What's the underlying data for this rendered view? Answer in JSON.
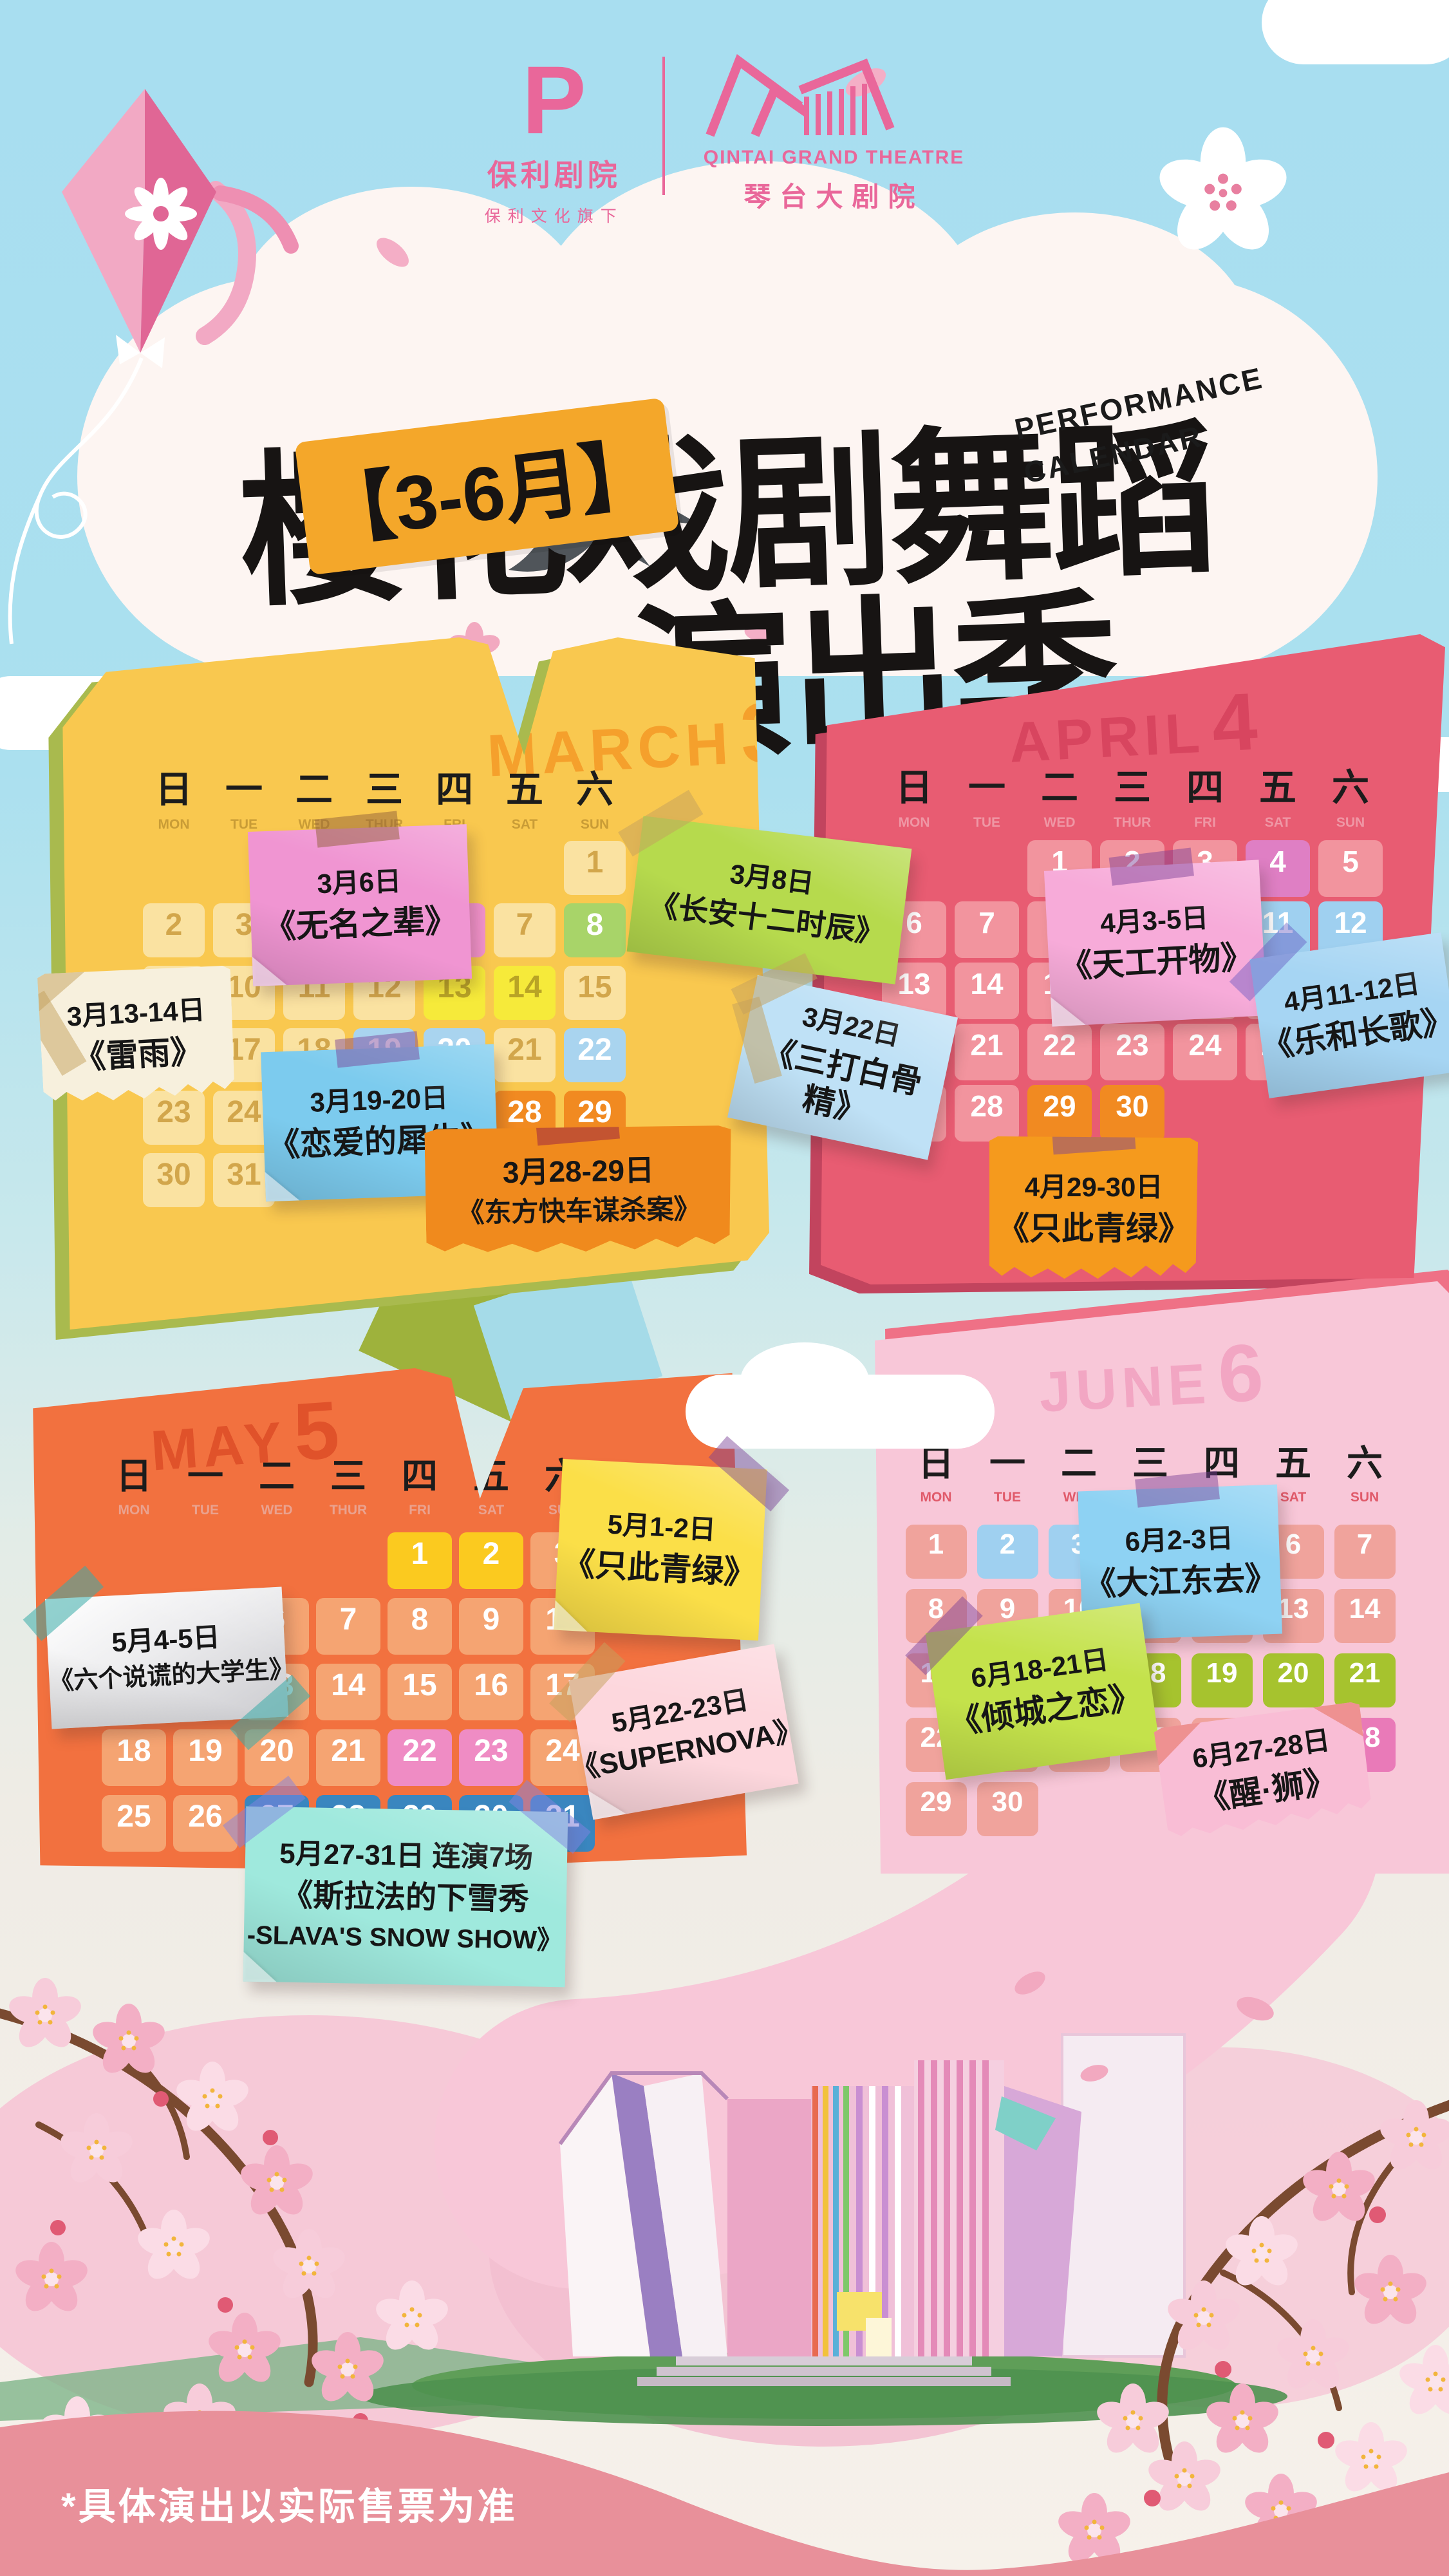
{
  "header": {
    "poly_logo": {
      "glyph": "P",
      "name_cn": "保利剧院",
      "sub_cn": "保利文化旗下"
    },
    "qintai_logo": {
      "name_en": "QINTAI GRAND THEATRE",
      "name_cn": "琴台大剧院"
    }
  },
  "title": {
    "line1": "樱花戏剧舞蹈",
    "line2": "演出季",
    "badge": "【3-6月】",
    "subtitle_en_line1": "PERFORMANCE",
    "subtitle_en_line2": "CALENDAR"
  },
  "months": [
    {
      "id": "march",
      "name_en": "MARCH",
      "num": "3",
      "weekdays_cn": [
        "日",
        "一",
        "二",
        "三",
        "四",
        "五",
        "六"
      ],
      "weekdays_en": [
        "MON",
        "TUE",
        "WED",
        "THUR",
        "FRI",
        "SAT",
        "SUN"
      ],
      "rows": [
        [
          "",
          "",
          "",
          "",
          "",
          "",
          "1"
        ],
        [
          "2",
          "3",
          "4",
          "5",
          "6|pink",
          "7",
          "8|green"
        ],
        [
          "9",
          "10",
          "11",
          "12",
          "13|yellow",
          "14|yellow",
          "15"
        ],
        [
          "16",
          "17",
          "18",
          "19|blue",
          "20|blue",
          "21",
          "22|blue"
        ],
        [
          "23",
          "24",
          "25",
          "26",
          "27",
          "28|orange",
          "29|orange"
        ],
        [
          "30",
          "31",
          "",
          "",
          "",
          "",
          ""
        ]
      ]
    },
    {
      "id": "april",
      "name_en": "APRIL",
      "num": "4",
      "weekdays_cn": [
        "日",
        "一",
        "二",
        "三",
        "四",
        "五",
        "六"
      ],
      "weekdays_en": [
        "MON",
        "TUE",
        "WED",
        "THUR",
        "FRI",
        "SAT",
        "SUN"
      ],
      "rows": [
        [
          "",
          "",
          "1",
          "2",
          "3",
          "4|plum",
          "5"
        ],
        [
          "6",
          "7",
          "8",
          "9",
          "10",
          "11|ltblue",
          "12|ltblue"
        ],
        [
          "13",
          "14",
          "15",
          "16",
          "17",
          "18",
          "19"
        ],
        [
          "20",
          "21",
          "22",
          "23",
          "24",
          "25",
          "26"
        ],
        [
          "27",
          "28",
          "29|orange",
          "30|orange",
          "",
          "",
          ""
        ]
      ]
    },
    {
      "id": "may",
      "name_en": "MAY",
      "num": "5",
      "weekdays_cn": [
        "日",
        "一",
        "二",
        "三",
        "四",
        "五",
        "六"
      ],
      "weekdays_en": [
        "MON",
        "TUE",
        "WED",
        "THUR",
        "FRI",
        "SAT",
        "SUN"
      ],
      "rows": [
        [
          "",
          "",
          "",
          "",
          "1|vividyellow",
          "2|vividyellow",
          "3"
        ],
        [
          "4|white",
          "5|white",
          "6",
          "7",
          "8",
          "9",
          "10"
        ],
        [
          "11",
          "12",
          "13",
          "14",
          "15",
          "16",
          "17"
        ],
        [
          "18",
          "19",
          "20",
          "21",
          "22|rose",
          "23|rose",
          "24"
        ],
        [
          "25",
          "26",
          "27|dkblue",
          "28|dkblue",
          "29|dkblue",
          "30|dkblue",
          "31|dkblue"
        ]
      ]
    },
    {
      "id": "june",
      "name_en": "JUNE",
      "num": "6",
      "weekdays_cn": [
        "日",
        "一",
        "二",
        "三",
        "四",
        "五",
        "六"
      ],
      "weekdays_en": [
        "MON",
        "TUE",
        "WED",
        "THUR",
        "FRI",
        "SAT",
        "SUN"
      ],
      "rows": [
        [
          "1",
          "2|ltblue",
          "3|ltblue",
          "4",
          "5",
          "6",
          "7"
        ],
        [
          "8",
          "9",
          "10",
          "11",
          "12",
          "13",
          "14"
        ],
        [
          "15",
          "16",
          "17",
          "18|lime",
          "19|lime",
          "20|lime",
          "21|lime"
        ],
        [
          "22",
          "23",
          "24",
          "25",
          "26",
          "27|dkpink",
          "28|dkpink"
        ],
        [
          "29",
          "30",
          "",
          "",
          "",
          "",
          ""
        ]
      ]
    }
  ],
  "notes": [
    {
      "id": "n1",
      "date": "3月6日",
      "lines": [
        "《无名之辈》"
      ],
      "color": "#f095d2"
    },
    {
      "id": "n2",
      "date": "3月8日",
      "lines": [
        "《长安十二时辰》"
      ],
      "color": "#b6da4d"
    },
    {
      "id": "n3",
      "date": "3月13-14日",
      "lines": [
        "《雷雨》"
      ],
      "color": "#f7f0dd"
    },
    {
      "id": "n4",
      "date": "3月19-20日",
      "lines": [
        "《恋爱的犀牛》"
      ],
      "color": "#7ccbee"
    },
    {
      "id": "n5",
      "date": "3月22日",
      "lines": [
        "《三打白骨精》"
      ],
      "color": "#bfe1f6"
    },
    {
      "id": "n6",
      "date": "3月28-29日",
      "lines": [
        "《东方快车谋杀案》"
      ],
      "color": "#f08a1d"
    },
    {
      "id": "n7",
      "date": "4月3-5日",
      "lines": [
        "《天工开物》"
      ],
      "color": "#f7abd9"
    },
    {
      "id": "n8",
      "date": "4月11-12日",
      "lines": [
        "《乐和长歌》"
      ],
      "color": "#a6d5f3"
    },
    {
      "id": "n9",
      "date": "4月29-30日",
      "lines": [
        "《只此青绿》"
      ],
      "color": "#f59a1d"
    },
    {
      "id": "n10",
      "date": "5月1-2日",
      "lines": [
        "《只此青绿》"
      ],
      "color": "#fbdf48"
    },
    {
      "id": "n11",
      "date": "5月4-5日",
      "lines": [
        "《六个说谎的大学生》"
      ],
      "color": "#ffffff"
    },
    {
      "id": "n12",
      "date": "5月22-23日",
      "lines": [
        "《SUPERNOVA》"
      ],
      "color": "#fdd7dd"
    },
    {
      "id": "n13",
      "date": "5月27-31日  连演7场",
      "lines": [
        "《斯拉法的下雪秀",
        "-SLAVA'S SNOW SHOW》"
      ],
      "color": "#9fe9dd"
    },
    {
      "id": "n14",
      "date": "6月2-3日",
      "lines": [
        "《大江东去》"
      ],
      "color": "#8ed2f3"
    },
    {
      "id": "n15",
      "date": "6月18-21日",
      "lines": [
        "《倾城之恋》"
      ],
      "color": "#c4e24b"
    },
    {
      "id": "n16",
      "date": "6月27-28日",
      "lines": [
        "《醒·狮》"
      ],
      "color": "#f9bdd5"
    }
  ],
  "footer": {
    "disclaimer": "*具体演出以实际售票为准"
  },
  "palette": {
    "sky": "#abe0ef",
    "cloud_white": "#fdf5f2",
    "brand_pink": "#e9679a",
    "title_black": "#171413",
    "badge_orange": "#f4a72a",
    "march_board": "#f9c84f",
    "march_shadow": "#a9ba4e",
    "march_title": "#f5a02c",
    "march_cell": "#fae2a1",
    "march_cell_text": "#d2a64b",
    "march_wd_en": "#c99c36",
    "april_board": "#e85c72",
    "april_shadow": "#c2445e",
    "april_title": "#d8455f",
    "april_cell": "#f2949e",
    "april_wd_en": "#ef97a5",
    "may_board": "#f2713f",
    "may_title": "#e0522a",
    "may_cell": "#f5a472",
    "may_wd_en": "#eaa28f",
    "june_board": "#f8c7d8",
    "june_shadow": "#ef7186",
    "june_title": "#f2a6c3",
    "june_cell": "#f0a39c",
    "june_wd_en": "#e05a6a",
    "hl_pink": "#f292cb",
    "hl_green": "#a8d469",
    "hl_yellow": "#f6ea3a",
    "hl_yellow_text": "#b9a425",
    "hl_blue": "#a9d4ef",
    "hl_orange": "#f18a21",
    "hl_plum": "#df7fc4",
    "hl_ltblue": "#9fd0f0",
    "hl_vividyellow": "#fbca1f",
    "hl_white": "#ffffff",
    "hl_white_text": "#e8552e",
    "hl_rose": "#ef8cc4",
    "hl_dkblue": "#3a86bf",
    "hl_lime": "#a6c32e",
    "hl_dkpink": "#e97ab8",
    "band_pink": "#e8909a",
    "red_mark": "#e3251f",
    "arrow_pink": "#e8679a"
  },
  "icons": {
    "kite": "kite-icon",
    "swallow": "swallow-icon",
    "blossom": "blossom-icon",
    "cloud": "cloud-shape",
    "check": "red-check-annotation",
    "circle": "red-circle-annotation",
    "arrow": "pink-arrow-annotation",
    "theatre": "theatre-building-illustration"
  }
}
